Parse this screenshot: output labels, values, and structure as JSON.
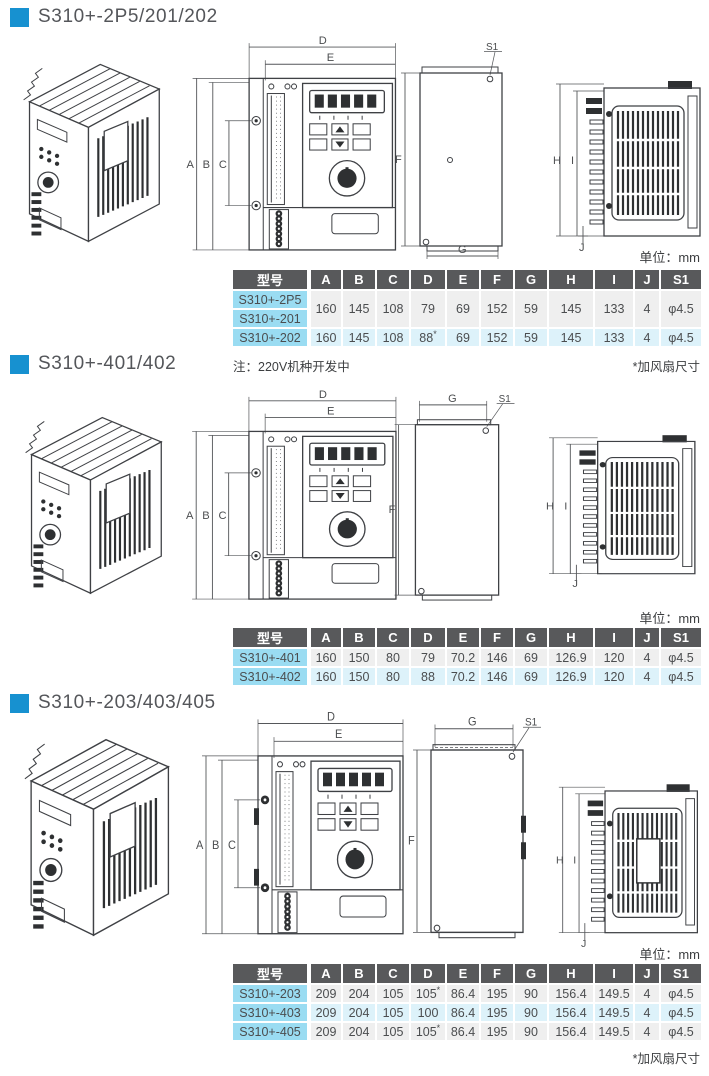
{
  "page": {
    "unit_label": "单位：mm",
    "dev_note": "注：220V机种开发中",
    "fan_note": "*加风扇尺寸"
  },
  "dim_labels": {
    "A": "A",
    "B": "B",
    "C": "C",
    "D": "D",
    "E": "E",
    "F": "F",
    "G": "G",
    "H": "H",
    "I": "I",
    "J": "J",
    "S1": "S1"
  },
  "colors": {
    "accent_blue": "#1791D0",
    "header_gray": "#58595B",
    "model_cyan": "#9ADCF2",
    "row_gray": "#EFEFEF",
    "row_blue": "#DDF2FA"
  },
  "sections": [
    {
      "title": "S310+-2P5/201/202",
      "table": {
        "model_header": "型号",
        "col_headers": [
          "A",
          "B",
          "C",
          "D",
          "E",
          "F",
          "G",
          "H",
          "I",
          "J",
          "S1"
        ],
        "groups": [
          {
            "models": [
              "S310+-2P5",
              "S310+-201"
            ],
            "values": [
              "160",
              "145",
              "108",
              "79",
              "69",
              "152",
              "59",
              "145",
              "133",
              "4",
              "φ4.5"
            ]
          },
          {
            "models": [
              "S310+-202"
            ],
            "values": [
              "160",
              "145",
              "108",
              "88*",
              "69",
              "152",
              "59",
              "145",
              "133",
              "4",
              "φ4.5"
            ]
          }
        ]
      },
      "notes_left": "注：220V机种开发中",
      "notes_right": "*加风扇尺寸"
    },
    {
      "title": "S310+-401/402",
      "table": {
        "model_header": "型号",
        "col_headers": [
          "A",
          "B",
          "C",
          "D",
          "E",
          "F",
          "G",
          "H",
          "I",
          "J",
          "S1"
        ],
        "groups": [
          {
            "models": [
              "S310+-401"
            ],
            "values": [
              "160",
              "150",
              "80",
              "79",
              "70.2",
              "146",
              "69",
              "126.9",
              "120",
              "4",
              "φ4.5"
            ]
          },
          {
            "models": [
              "S310+-402"
            ],
            "values": [
              "160",
              "150",
              "80",
              "88",
              "70.2",
              "146",
              "69",
              "126.9",
              "120",
              "4",
              "φ4.5"
            ]
          }
        ]
      }
    },
    {
      "title": "S310+-203/403/405",
      "table": {
        "model_header": "型号",
        "col_headers": [
          "A",
          "B",
          "C",
          "D",
          "E",
          "F",
          "G",
          "H",
          "I",
          "J",
          "S1"
        ],
        "groups": [
          {
            "models": [
              "S310+-203"
            ],
            "values": [
              "209",
              "204",
              "105",
              "105*",
              "86.4",
              "195",
              "90",
              "156.4",
              "149.5",
              "4",
              "φ4.5"
            ]
          },
          {
            "models": [
              "S310+-403"
            ],
            "values": [
              "209",
              "204",
              "105",
              "100",
              "86.4",
              "195",
              "90",
              "156.4",
              "149.5",
              "4",
              "φ4.5"
            ]
          },
          {
            "models": [
              "S310+-405"
            ],
            "values": [
              "209",
              "204",
              "105",
              "105*",
              "86.4",
              "195",
              "90",
              "156.4",
              "149.5",
              "4",
              "φ4.5"
            ]
          }
        ]
      },
      "notes_right": "*加风扇尺寸"
    }
  ]
}
